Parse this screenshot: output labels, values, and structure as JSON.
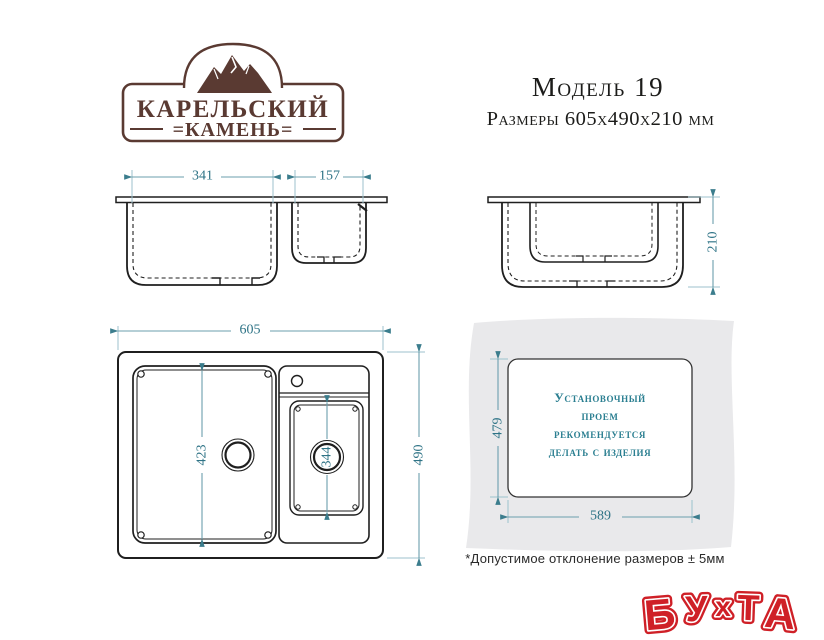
{
  "brand_logo": {
    "line1": "КАРЕЛЬСКИЙ",
    "line2": "=КАМЕНЬ="
  },
  "header": {
    "model": "Модель 19",
    "dimensions": "Размеры 605х490х210 мм"
  },
  "front_view": {
    "main_bowl_width": "341",
    "small_bowl_width": "157"
  },
  "side_view": {
    "depth": "210"
  },
  "top_view": {
    "overall_width": "605",
    "overall_depth": "490",
    "main_bowl_length": "423",
    "small_bowl_length": "344"
  },
  "cutout_diagram": {
    "width": "589",
    "height": "479",
    "note_lines": [
      "Установочный",
      "проем",
      "рекомендуется",
      "делать с изделия"
    ]
  },
  "footnote": "*Допустимое отклонение размеров ± 5мм",
  "watermark": {
    "text": "БУХТА",
    "letters": [
      "Б",
      "У",
      "х",
      "Т",
      "А"
    ]
  },
  "colors": {
    "brand_brown": "#5a3a32",
    "dimension_teal": "#2e7386",
    "cutout_text_teal": "#2b7f91",
    "drawing_line": "#1f1f1f",
    "counter_gray": "#e9e9eb",
    "watermark_red": "#cf2027"
  }
}
